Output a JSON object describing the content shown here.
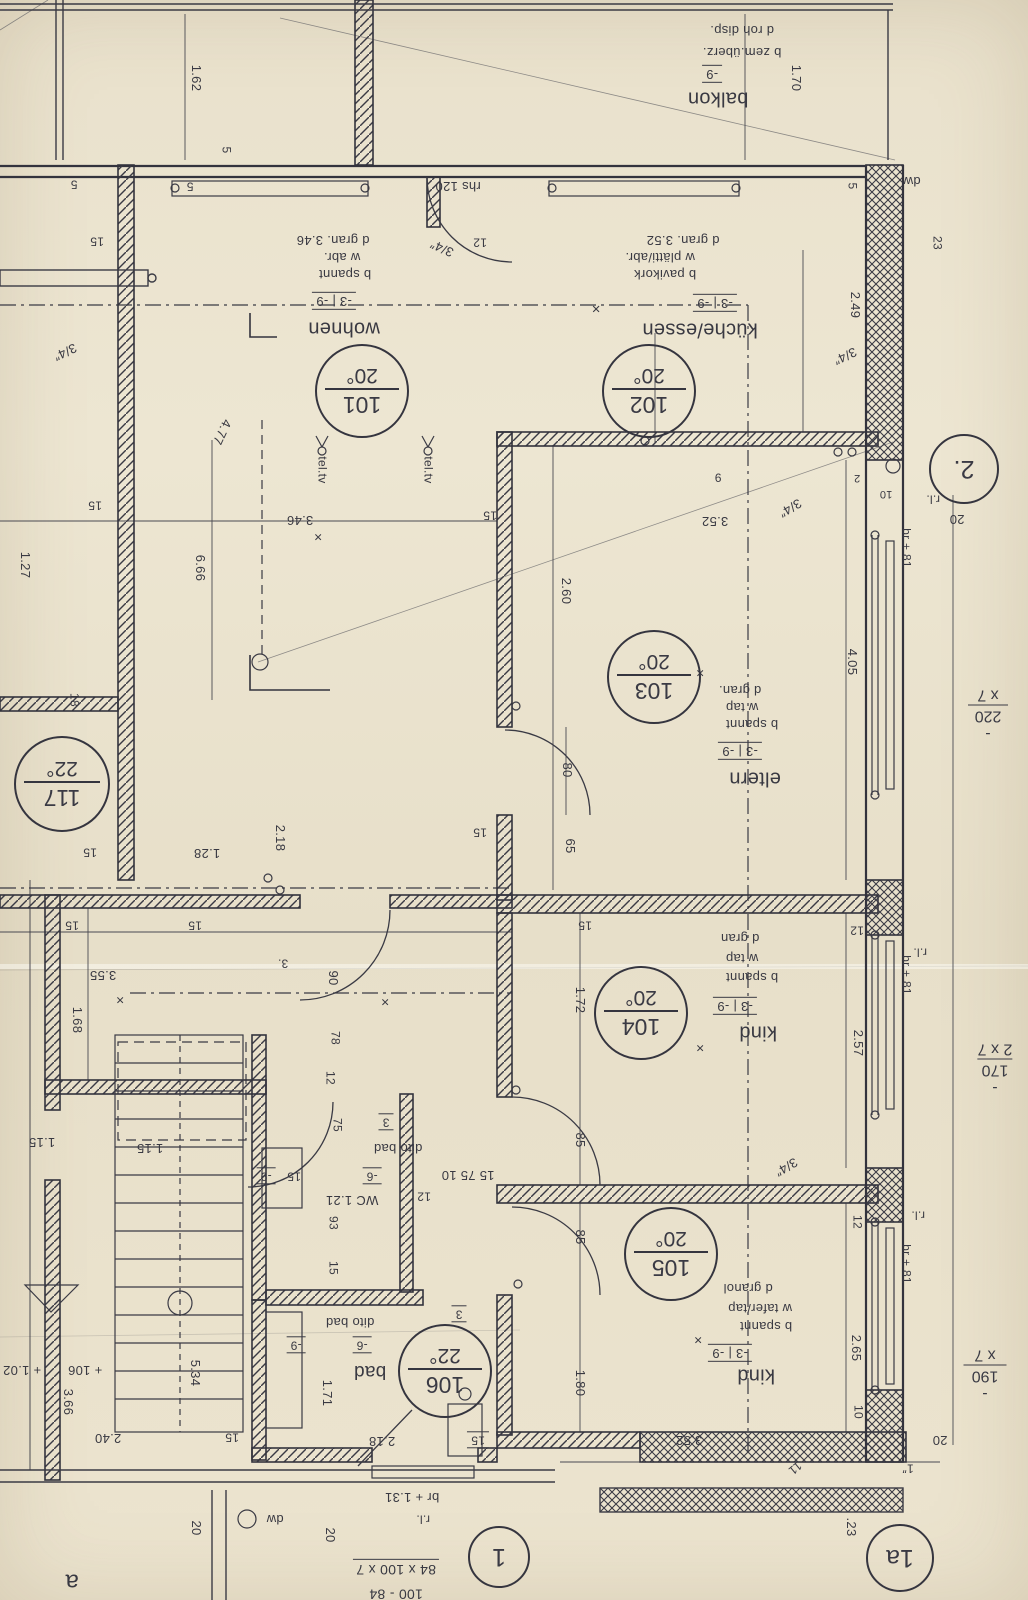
{
  "sheet": {
    "paper_color": "#e9e1cc",
    "ink_color": "#3a3a44"
  },
  "rooms": [
    {
      "number": "101",
      "temp": "20°",
      "name": "wohnen",
      "level": "-3 | -9",
      "finishes": [
        "b spannt",
        "w abr.",
        "d gran. 3.46"
      ],
      "stamp": {
        "x": 360,
        "y": 389,
        "r": 45
      }
    },
    {
      "number": "102",
      "temp": "20°",
      "name": "küche/essen",
      "level": "-3 | -9",
      "finishes": [
        "b pavikork",
        "w plätti/abr.",
        "d gran. 3.52"
      ],
      "stamp": {
        "x": 647,
        "y": 389,
        "r": 45
      }
    },
    {
      "number": "103",
      "temp": "20°",
      "name": "eltern",
      "level": "-3 | -9",
      "finishes": [
        "b spannt",
        "w tap",
        "d gran."
      ],
      "stamp": {
        "x": 652,
        "y": 675,
        "r": 45
      }
    },
    {
      "number": "104",
      "temp": "20°",
      "name": "kind",
      "level": "-3 | -9",
      "finishes": [
        "b spannt",
        "w tap",
        "d gran"
      ],
      "stamp": {
        "x": 639,
        "y": 1011,
        "r": 45
      }
    },
    {
      "number": "105",
      "temp": "20°",
      "name": "kind",
      "level": "-3 | -9",
      "finishes": [
        "b spannt",
        "w tafer/tap",
        "d granol"
      ],
      "stamp": {
        "x": 669,
        "y": 1252,
        "r": 45
      }
    },
    {
      "number": "106",
      "temp": "22°",
      "name": "bad",
      "level": "-6 | -9",
      "finishes": [
        "dito bad"
      ],
      "stamp": {
        "x": 443,
        "y": 1369,
        "r": 45
      }
    },
    {
      "number": "117",
      "temp": "22°",
      "name": "",
      "level": "",
      "finishes": [],
      "stamp": {
        "x": 60,
        "y": 782,
        "r": 46
      }
    }
  ],
  "position_markers": [
    {
      "label": "2.",
      "x": 962,
      "y": 467,
      "r": 33
    },
    {
      "label": "1",
      "x": 497,
      "y": 1555,
      "r": 29
    },
    {
      "label": "1a",
      "x": 898,
      "y": 1556,
      "r": 32
    }
  ],
  "window_specs": [
    {
      "lines": [
        "- 220",
        "x 7"
      ],
      "x": 988,
      "y": 714
    },
    {
      "lines": [
        "- 170",
        "2 x 7"
      ],
      "x": 995,
      "y": 1068
    },
    {
      "lines": [
        "- 190",
        "x 7"
      ],
      "x": 985,
      "y": 1374
    }
  ],
  "labels": [
    {
      "t": "d roh disp.",
      "x": 742,
      "y": 30
    },
    {
      "t": "b zem.überz.",
      "x": 742,
      "y": 52
    },
    {
      "t": "-9",
      "x": 712,
      "y": 74,
      "c": "lvl"
    },
    {
      "t": "balkon",
      "x": 718,
      "y": 98,
      "s": 20,
      "n": "room-name-balkon"
    },
    {
      "t": "1.70",
      "x": 796,
      "y": 78,
      "r": 90
    },
    {
      "t": "1.62",
      "x": 196,
      "y": 78,
      "r": 90
    },
    {
      "t": "5",
      "x": 190,
      "y": 186,
      "s": 12
    },
    {
      "t": "5",
      "x": 226,
      "y": 150,
      "r": 90,
      "s": 12
    },
    {
      "t": "5",
      "x": 74,
      "y": 184,
      "s": 12
    },
    {
      "t": "15",
      "x": 97,
      "y": 241,
      "s": 12
    },
    {
      "t": "5",
      "x": 852,
      "y": 186,
      "r": 90,
      "s": 12
    },
    {
      "t": "dw",
      "x": 912,
      "y": 181,
      "n": "note-dw"
    },
    {
      "t": "23",
      "x": 937,
      "y": 243,
      "r": 90,
      "s": 12
    },
    {
      "t": "2.49",
      "x": 855,
      "y": 305,
      "r": 90
    },
    {
      "t": "rhs 120",
      "x": 458,
      "y": 186
    },
    {
      "t": "12",
      "x": 480,
      "y": 242,
      "s": 12
    },
    {
      "t": "3/4″",
      "x": 442,
      "y": 248,
      "r": 205
    },
    {
      "t": "3/4″",
      "x": 845,
      "y": 356,
      "r": 155
    },
    {
      "t": "d gran. 3.46",
      "x": 333,
      "y": 240
    },
    {
      "t": "w abr.",
      "x": 342,
      "y": 257
    },
    {
      "t": "b spannt",
      "x": 345,
      "y": 274
    },
    {
      "t": "-3 | -9",
      "x": 334,
      "y": 301,
      "c": "lvl"
    },
    {
      "t": "wohnen",
      "x": 344,
      "y": 328,
      "s": 20,
      "n": "room-name-wohnen"
    },
    {
      "t": "d gran. 3.52",
      "x": 683,
      "y": 240
    },
    {
      "t": "w plätti/abr.",
      "x": 660,
      "y": 257
    },
    {
      "t": "b pavikork",
      "x": 665,
      "y": 274
    },
    {
      "t": "-3 | -9",
      "x": 715,
      "y": 303,
      "c": "lvl"
    },
    {
      "t": "küche/essen",
      "x": 700,
      "y": 329,
      "s": 20,
      "n": "room-name-kueche-essen"
    },
    {
      "t": "×",
      "x": 596,
      "y": 308,
      "s": 15
    },
    {
      "t": "3/4″",
      "x": 65,
      "y": 352,
      "r": 155
    },
    {
      "t": "4.77",
      "x": 222,
      "y": 432,
      "r": 115
    },
    {
      "t": "tel.tv",
      "x": 322,
      "y": 470,
      "r": 90,
      "s": 12
    },
    {
      "t": "tel.tv",
      "x": 428,
      "y": 470,
      "r": 90,
      "s": 12
    },
    {
      "t": "15",
      "x": 95,
      "y": 505,
      "s": 12
    },
    {
      "t": "1.27",
      "x": 25,
      "y": 565,
      "r": 90
    },
    {
      "t": "6.66",
      "x": 200,
      "y": 568,
      "r": 90
    },
    {
      "t": "3.46",
      "x": 300,
      "y": 520
    },
    {
      "t": "×",
      "x": 318,
      "y": 537,
      "s": 14
    },
    {
      "t": "3.52",
      "x": 715,
      "y": 521
    },
    {
      "t": "15",
      "x": 490,
      "y": 515,
      "s": 12
    },
    {
      "t": "9",
      "x": 718,
      "y": 477,
      "s": 12
    },
    {
      "t": "2",
      "x": 857,
      "y": 477,
      "s": 11
    },
    {
      "t": "10",
      "x": 886,
      "y": 493,
      "s": 11
    },
    {
      "t": "3/4″",
      "x": 790,
      "y": 508,
      "r": 150
    },
    {
      "t": "r.l.",
      "x": 933,
      "y": 499,
      "s": 12
    },
    {
      "t": "20",
      "x": 957,
      "y": 519
    },
    {
      "t": "br + 81",
      "x": 906,
      "y": 548,
      "r": 90,
      "s": 12
    },
    {
      "t": "2.60",
      "x": 566,
      "y": 591,
      "r": 90
    },
    {
      "t": "4.05",
      "x": 852,
      "y": 662,
      "r": 90
    },
    {
      "t": "×",
      "x": 700,
      "y": 673,
      "s": 14
    },
    {
      "t": "d gran.",
      "x": 740,
      "y": 690
    },
    {
      "t": "w tap",
      "x": 742,
      "y": 707
    },
    {
      "t": "b spannt",
      "x": 752,
      "y": 724
    },
    {
      "t": "-3 | -9",
      "x": 740,
      "y": 751,
      "c": "lvl"
    },
    {
      "t": "eltern",
      "x": 755,
      "y": 778,
      "s": 20,
      "n": "room-name-eltern"
    },
    {
      "t": "80",
      "x": 567,
      "y": 770,
      "r": 90
    },
    {
      "t": "65",
      "x": 570,
      "y": 846,
      "r": 90
    },
    {
      "t": "15",
      "x": 480,
      "y": 832,
      "s": 12
    },
    {
      "t": "1.28",
      "x": 207,
      "y": 853
    },
    {
      "t": "2.18",
      "x": 280,
      "y": 838,
      "r": 90
    },
    {
      "t": "15",
      "x": 90,
      "y": 852,
      "s": 12
    },
    {
      "t": "18",
      "x": 74,
      "y": 700,
      "r": 90,
      "s": 12
    },
    {
      "t": "15",
      "x": 72,
      "y": 925,
      "s": 12
    },
    {
      "t": "15",
      "x": 195,
      "y": 925,
      "s": 12
    },
    {
      "t": "15",
      "x": 585,
      "y": 925,
      "s": 12
    },
    {
      "t": "12",
      "x": 857,
      "y": 930,
      "s": 12
    },
    {
      "t": "3.55",
      "x": 103,
      "y": 975
    },
    {
      "t": "×",
      "x": 120,
      "y": 1000,
      "s": 14
    },
    {
      "t": "1.68",
      "x": 77,
      "y": 1020,
      "r": 90
    },
    {
      "t": "3.",
      "x": 283,
      "y": 963,
      "s": 12
    },
    {
      "t": "90",
      "x": 333,
      "y": 978,
      "r": 90
    },
    {
      "t": "×",
      "x": 385,
      "y": 1002,
      "s": 14
    },
    {
      "t": "78",
      "x": 335,
      "y": 1038,
      "r": 90,
      "s": 12
    },
    {
      "t": "12",
      "x": 330,
      "y": 1078,
      "r": 90,
      "s": 12
    },
    {
      "t": "1.72",
      "x": 580,
      "y": 1000,
      "r": 90
    },
    {
      "t": "d gran",
      "x": 740,
      "y": 938
    },
    {
      "t": "w tap",
      "x": 742,
      "y": 958
    },
    {
      "t": "b spannt",
      "x": 752,
      "y": 977
    },
    {
      "t": "-3 | -9",
      "x": 735,
      "y": 1006,
      "c": "lvl"
    },
    {
      "t": "kind",
      "x": 758,
      "y": 1032,
      "s": 20,
      "n": "room-name-kind-104"
    },
    {
      "t": "×",
      "x": 700,
      "y": 1048,
      "s": 14
    },
    {
      "t": "2.57",
      "x": 858,
      "y": 1043,
      "r": 90
    },
    {
      "t": "r.l.",
      "x": 920,
      "y": 952,
      "s": 12
    },
    {
      "t": "br + 81",
      "x": 906,
      "y": 975,
      "r": 90,
      "s": 12
    },
    {
      "t": "85",
      "x": 580,
      "y": 1140,
      "r": 90
    },
    {
      "t": "75",
      "x": 337,
      "y": 1125,
      "r": 90,
      "s": 12
    },
    {
      "t": "3",
      "x": 386,
      "y": 1122,
      "c": "lvl",
      "s": 12
    },
    {
      "t": "dito bad",
      "x": 398,
      "y": 1148
    },
    {
      "t": "-6",
      "x": 372,
      "y": 1176,
      "c": "lvl",
      "s": 12
    },
    {
      "t": "WC 1.21",
      "x": 352,
      "y": 1200
    },
    {
      "t": "12",
      "x": 424,
      "y": 1196,
      "s": 12
    },
    {
      "t": "15 75 10",
      "x": 468,
      "y": 1175
    },
    {
      "t": "-9",
      "x": 266,
      "y": 1176,
      "c": "lvl",
      "s": 12
    },
    {
      "t": "15",
      "x": 294,
      "y": 1176,
      "s": 12
    },
    {
      "t": "93",
      "x": 333,
      "y": 1223,
      "r": 90,
      "s": 12
    },
    {
      "t": "15",
      "x": 333,
      "y": 1268,
      "r": 90,
      "s": 12
    },
    {
      "t": "1.15",
      "x": 42,
      "y": 1142
    },
    {
      "t": "1.15",
      "x": 150,
      "y": 1148
    },
    {
      "t": "3/4″",
      "x": 786,
      "y": 1167,
      "r": 150
    },
    {
      "t": "12",
      "x": 857,
      "y": 1222,
      "r": 90,
      "s": 12
    },
    {
      "t": "r.l.",
      "x": 918,
      "y": 1215,
      "s": 12
    },
    {
      "t": "br + 81",
      "x": 906,
      "y": 1264,
      "r": 90,
      "s": 12
    },
    {
      "t": "d granol",
      "x": 748,
      "y": 1288
    },
    {
      "t": "w tafer/tap",
      "x": 760,
      "y": 1308
    },
    {
      "t": "b spannt",
      "x": 766,
      "y": 1326
    },
    {
      "t": "×",
      "x": 698,
      "y": 1340,
      "s": 14
    },
    {
      "t": "-3 | -9",
      "x": 730,
      "y": 1353,
      "c": "lvl"
    },
    {
      "t": "kind",
      "x": 756,
      "y": 1375,
      "s": 20,
      "n": "room-name-kind-105"
    },
    {
      "t": "85",
      "x": 580,
      "y": 1237,
      "r": 90
    },
    {
      "t": "1.80",
      "x": 580,
      "y": 1383,
      "r": 90
    },
    {
      "t": "3.52",
      "x": 689,
      "y": 1440
    },
    {
      "t": "2.65",
      "x": 856,
      "y": 1348,
      "r": 90
    },
    {
      "t": "10",
      "x": 858,
      "y": 1412,
      "r": 90,
      "s": 12
    },
    {
      "t": "dito bad",
      "x": 350,
      "y": 1322
    },
    {
      "t": "-6",
      "x": 362,
      "y": 1345,
      "c": "lvl",
      "s": 12
    },
    {
      "t": "-9",
      "x": 296,
      "y": 1345,
      "c": "lvl",
      "s": 12
    },
    {
      "t": "bad",
      "x": 370,
      "y": 1371,
      "s": 19,
      "n": "room-name-bad"
    },
    {
      "t": "3",
      "x": 459,
      "y": 1314,
      "c": "lvl",
      "s": 12
    },
    {
      "t": "1.71",
      "x": 327,
      "y": 1393,
      "r": 90
    },
    {
      "t": "2.18",
      "x": 382,
      "y": 1441
    },
    {
      "t": "15",
      "x": 478,
      "y": 1440,
      "c": "lvl",
      "s": 12
    },
    {
      "t": "br + 1.31",
      "x": 412,
      "y": 1497
    },
    {
      "t": "r.l.",
      "x": 423,
      "y": 1519,
      "s": 12
    },
    {
      "t": "84 x 100 x 7",
      "x": 396,
      "y": 1568,
      "c": "ul",
      "s": 14
    },
    {
      "t": "100 - 84",
      "x": 396,
      "y": 1594,
      "s": 14
    },
    {
      "t": "+ 106",
      "x": 85,
      "y": 1370
    },
    {
      "t": "+ 1.02",
      "x": 22,
      "y": 1370
    },
    {
      "t": "3.66",
      "x": 68,
      "y": 1402,
      "r": 90
    },
    {
      "t": "2.40",
      "x": 108,
      "y": 1438
    },
    {
      "t": "5.34",
      "x": 195,
      "y": 1373,
      "r": 90
    },
    {
      "t": "15",
      "x": 232,
      "y": 1437,
      "s": 12
    },
    {
      "t": "20",
      "x": 196,
      "y": 1528,
      "r": 90
    },
    {
      "t": "dw",
      "x": 275,
      "y": 1519,
      "n": "note-dw"
    },
    {
      "t": "20",
      "x": 330,
      "y": 1535,
      "r": 90
    },
    {
      "t": "a",
      "x": 72,
      "y": 1582,
      "s": 24,
      "n": "grid-letter-a"
    },
    {
      "t": "11",
      "x": 795,
      "y": 1468,
      "r": 140,
      "s": 12
    },
    {
      "t": "1″",
      "x": 908,
      "y": 1468,
      "s": 12
    },
    {
      "t": "20",
      "x": 940,
      "y": 1440
    },
    {
      "t": ".23",
      "x": 851,
      "y": 1527,
      "r": 90
    }
  ]
}
